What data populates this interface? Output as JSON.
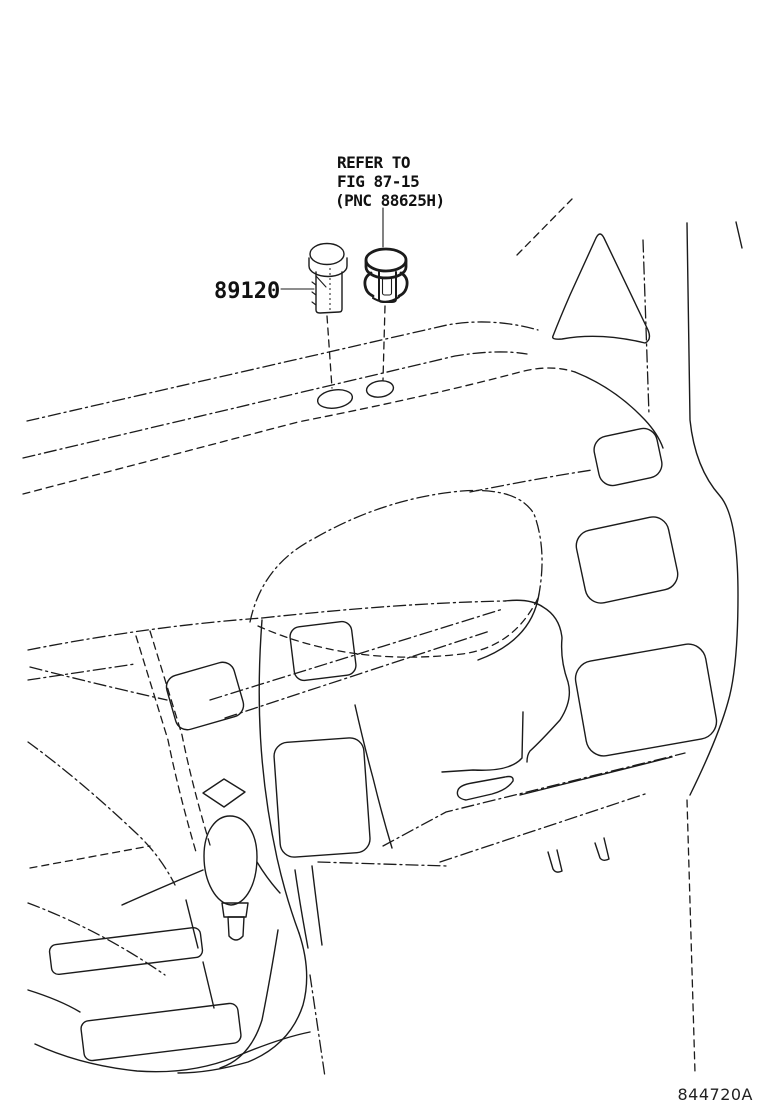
{
  "page": {
    "background_color": "#ffffff",
    "line_color": "#1b1b1b"
  },
  "callouts": {
    "part_number": "89120",
    "reference_note": {
      "line1": "REFER TO",
      "line2": "FIG 87-15",
      "line3": "(PNC 88625H)"
    }
  },
  "footer": {
    "drawing_code": "844720A"
  }
}
